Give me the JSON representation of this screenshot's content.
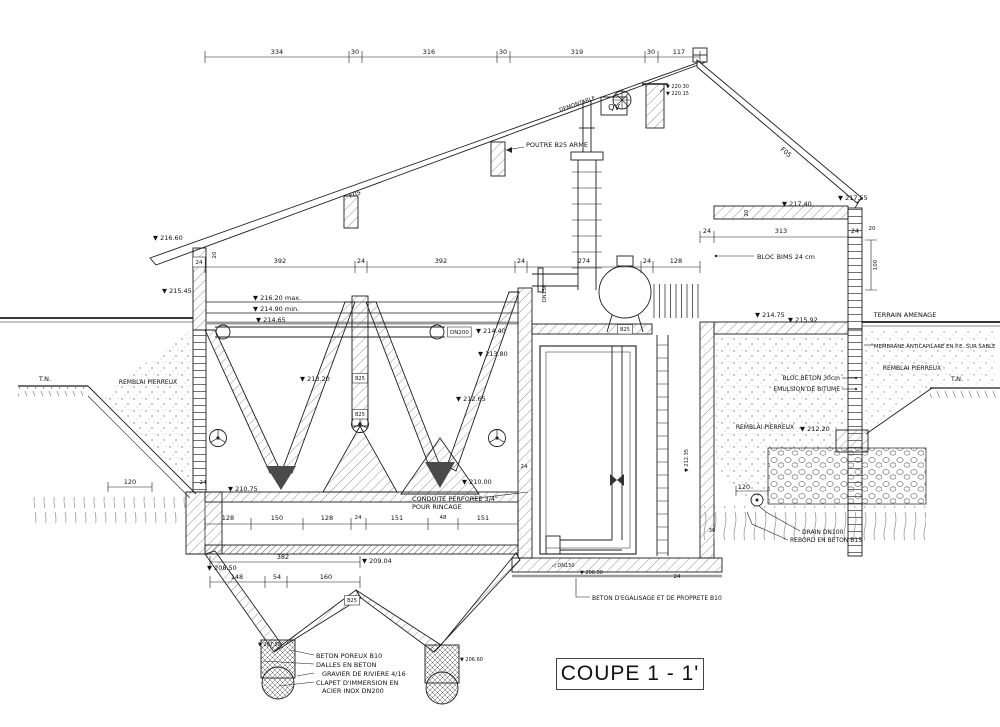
{
  "title": "COUPE 1 - 1'",
  "drawing": {
    "dimension_labels": [
      {
        "name": "dim-334",
        "text": "334",
        "x": 277,
        "y": 54
      },
      {
        "name": "dim-30a",
        "text": "30",
        "x": 355,
        "y": 54
      },
      {
        "name": "dim-316",
        "text": "316",
        "x": 429,
        "y": 54
      },
      {
        "name": "dim-30b",
        "text": "30",
        "x": 503,
        "y": 54
      },
      {
        "name": "dim-319",
        "text": "319",
        "x": 577,
        "y": 54
      },
      {
        "name": "dim-30c",
        "text": "30",
        "x": 651,
        "y": 54
      },
      {
        "name": "dim-117",
        "text": "117",
        "x": 679,
        "y": 54
      },
      {
        "name": "dim-392a",
        "text": "392",
        "x": 280,
        "y": 263
      },
      {
        "name": "dim-24a",
        "text": "24",
        "x": 361,
        "y": 263
      },
      {
        "name": "dim-392b",
        "text": "392",
        "x": 441,
        "y": 263
      },
      {
        "name": "dim-24b",
        "text": "24",
        "x": 521,
        "y": 263
      },
      {
        "name": "dim-274",
        "text": "274",
        "x": 584,
        "y": 263
      },
      {
        "name": "dim-24c",
        "text": "24",
        "x": 647,
        "y": 263
      },
      {
        "name": "dim-128a",
        "text": "128",
        "x": 676,
        "y": 263
      },
      {
        "name": "dim-24-wall",
        "text": "24",
        "x": 199,
        "y": 264,
        "boxed": true,
        "fs": 5.5
      },
      {
        "name": "dim-20-eave",
        "text": "20",
        "x": 216,
        "y": 255,
        "rot": -90,
        "fs": 5.5
      },
      {
        "name": "dim-24d",
        "text": "24",
        "x": 707,
        "y": 233
      },
      {
        "name": "dim-313",
        "text": "313",
        "x": 781,
        "y": 233
      },
      {
        "name": "dim-24e",
        "text": "24",
        "x": 855,
        "y": 233
      },
      {
        "name": "dim-20b",
        "text": "20",
        "x": 872,
        "y": 230,
        "fs": 5.5
      },
      {
        "name": "dim-100",
        "text": "100",
        "x": 877,
        "y": 265,
        "rot": -90,
        "fs": 5.5
      },
      {
        "name": "dim-20c",
        "text": "20",
        "x": 748,
        "y": 213,
        "rot": -90,
        "fs": 5.5
      },
      {
        "name": "dim-120-left",
        "text": "120",
        "x": 130,
        "y": 484
      },
      {
        "name": "dim-24f",
        "text": "24",
        "x": 203,
        "y": 484,
        "fs": 5.5
      },
      {
        "name": "dim-24g",
        "text": "24",
        "x": 524,
        "y": 468,
        "fs": 5.5
      },
      {
        "name": "dim-128b",
        "text": "128",
        "x": 228,
        "y": 520
      },
      {
        "name": "dim-150",
        "text": "150",
        "x": 277,
        "y": 520
      },
      {
        "name": "dim-128c",
        "text": "128",
        "x": 327,
        "y": 520
      },
      {
        "name": "dim-24h",
        "text": "24",
        "x": 358,
        "y": 519,
        "fs": 5.5
      },
      {
        "name": "dim-151a",
        "text": "151",
        "x": 397,
        "y": 520
      },
      {
        "name": "dim-48",
        "text": "48",
        "x": 443,
        "y": 519,
        "fs": 5.5
      },
      {
        "name": "dim-151b",
        "text": "151",
        "x": 483,
        "y": 520
      },
      {
        "name": "dim-382",
        "text": "382",
        "x": 283,
        "y": 559
      },
      {
        "name": "dim-148",
        "text": "148",
        "x": 237,
        "y": 579
      },
      {
        "name": "dim-54",
        "text": "54",
        "x": 277,
        "y": 579
      },
      {
        "name": "dim-160",
        "text": "160",
        "x": 326,
        "y": 579
      },
      {
        "name": "dim-120-right",
        "text": "120",
        "x": 744,
        "y": 489
      },
      {
        "name": "dim-24i",
        "text": "24",
        "x": 677,
        "y": 578,
        "fs": 5.5
      },
      {
        "name": "dim-36",
        "text": "36",
        "x": 712,
        "y": 532,
        "fs": 5.5
      }
    ],
    "elevation_labels": [
      {
        "name": "elev-220-30",
        "text": "▼ 220.30",
        "x": 666,
        "y": 88,
        "fs": 5
      },
      {
        "name": "elev-220-15",
        "text": "▼ 220.15",
        "x": 666,
        "y": 95,
        "fs": 5
      },
      {
        "name": "elev-216-60",
        "text": "▼ 216.60",
        "x": 153,
        "y": 240
      },
      {
        "name": "elev-215-45",
        "text": "▼ 215.45",
        "x": 162,
        "y": 293
      },
      {
        "name": "elev-216-20-max",
        "text": "▼ 216.20 max.",
        "x": 253,
        "y": 300
      },
      {
        "name": "elev-214-90-min",
        "text": "▼ 214.90 min.",
        "x": 253,
        "y": 311
      },
      {
        "name": "elev-214-65",
        "text": "▼ 214.65",
        "x": 256,
        "y": 322
      },
      {
        "name": "elev-214-40",
        "text": "▼ 214.40",
        "x": 476,
        "y": 333
      },
      {
        "name": "elev-213-80",
        "text": "▼ 213.80",
        "x": 478,
        "y": 356
      },
      {
        "name": "elev-213-20",
        "text": "▼ 213.20",
        "x": 300,
        "y": 381
      },
      {
        "name": "elev-212-65",
        "text": "▼ 212.65",
        "x": 456,
        "y": 401
      },
      {
        "name": "elev-217-40",
        "text": "▼ 217.40",
        "x": 782,
        "y": 206
      },
      {
        "name": "elev-217-55",
        "text": "▼ 217.55",
        "x": 838,
        "y": 200
      },
      {
        "name": "elev-214-75",
        "text": "▼ 214.75",
        "x": 755,
        "y": 317
      },
      {
        "name": "elev-215-92",
        "text": "▼ 215.92",
        "x": 788,
        "y": 322
      },
      {
        "name": "elev-212-20",
        "text": "▼ 212.20",
        "x": 800,
        "y": 431
      },
      {
        "name": "elev-210-00",
        "text": "▼ 210.00",
        "x": 462,
        "y": 484
      },
      {
        "name": "elev-210-75",
        "text": "▼ 210.75",
        "x": 228,
        "y": 491
      },
      {
        "name": "elev-208-50",
        "text": "▼ 208.50",
        "x": 207,
        "y": 570
      },
      {
        "name": "elev-209-04",
        "text": "▼ 209.04",
        "x": 362,
        "y": 563
      },
      {
        "name": "elev-207-58",
        "text": "▼ 207.58",
        "x": 258,
        "y": 646,
        "fs": 5
      },
      {
        "name": "elev-206-60",
        "text": "▼ 206.60",
        "x": 460,
        "y": 661,
        "fs": 5
      },
      {
        "name": "elev-208-90",
        "text": "▼ 208.90",
        "x": 580,
        "y": 574,
        "fs": 5
      },
      {
        "name": "elev-212-35",
        "text": "▼ 212.35",
        "x": 688,
        "y": 472,
        "rot": -90,
        "fs": 5
      }
    ],
    "text_labels": [
      {
        "name": "label-poutre",
        "text": "POUTRE B25 ARME",
        "x": 526,
        "y": 147
      },
      {
        "name": "label-demontable",
        "text": "DEMONTABLE",
        "x": 560,
        "y": 112,
        "rot": -19.5,
        "fs": 5.5
      },
      {
        "name": "label-f05-left",
        "text": "F05",
        "x": 350,
        "y": 198,
        "rot": -19.5
      },
      {
        "name": "label-f05-right",
        "text": "F05",
        "x": 780,
        "y": 150,
        "rot": 40
      },
      {
        "name": "label-qv",
        "text": "QV",
        "x": 614,
        "y": 110,
        "anchor": "middle",
        "fs": 8
      },
      {
        "name": "label-bloc-bims",
        "text": "BLOC BIMS 24 cm",
        "x": 757,
        "y": 259
      },
      {
        "name": "label-terrain-amenage",
        "text": "TERRAIN AMENAGE",
        "x": 905,
        "y": 317,
        "anchor": "middle"
      },
      {
        "name": "label-membrane",
        "text": "MEMBRANE ANTICAPILARE EN P.E. SUR SABLE",
        "x": 874,
        "y": 348,
        "fs": 5.3
      },
      {
        "name": "label-remblai-right-upper",
        "text": "REMBLAI PIERREUX",
        "x": 912,
        "y": 370,
        "anchor": "middle",
        "fs": 6
      },
      {
        "name": "label-tn-right",
        "text": "T.N.",
        "x": 957,
        "y": 381,
        "anchor": "middle"
      },
      {
        "name": "label-bloc-beton",
        "text": "BLOC BETON 30cm",
        "x": 840,
        "y": 380,
        "anchor": "end",
        "fs": 6
      },
      {
        "name": "label-emulsion",
        "text": "EMULSION DE BITUME",
        "x": 840,
        "y": 391,
        "anchor": "end",
        "fs": 6
      },
      {
        "name": "label-remblai-right-lower",
        "text": "REMBLAI PIERREUX",
        "x": 765,
        "y": 429,
        "anchor": "middle",
        "fs": 6
      },
      {
        "name": "label-drain",
        "text": "DRAIN DN100",
        "x": 802,
        "y": 534,
        "fs": 6
      },
      {
        "name": "label-rebord",
        "text": "REBORD EN BETON B15",
        "x": 790,
        "y": 542,
        "fs": 6
      },
      {
        "name": "label-tn-left",
        "text": "T.N.",
        "x": 45,
        "y": 381,
        "anchor": "middle"
      },
      {
        "name": "label-remblai-left",
        "text": "REMBLAI PIERREUX",
        "x": 148,
        "y": 384,
        "anchor": "middle",
        "fs": 6
      },
      {
        "name": "label-conduite-1",
        "text": "CONDUITE PERFOREE 3/4\"",
        "x": 412,
        "y": 501
      },
      {
        "name": "label-conduite-2",
        "text": "POUR RINCAGE",
        "x": 412,
        "y": 509
      },
      {
        "name": "label-beton-egalisage",
        "text": "BETON D'EGALISAGE ET DE PROPRETE B10",
        "x": 592,
        "y": 600,
        "fs": 6
      },
      {
        "name": "label-beton-poreux",
        "text": "BETON POREUX B10",
        "x": 316,
        "y": 658
      },
      {
        "name": "label-dalles",
        "text": "DALLES EN BETON",
        "x": 316,
        "y": 667
      },
      {
        "name": "label-gravier",
        "text": "GRAVIER DE RIVIERE 4/16",
        "x": 322,
        "y": 676
      },
      {
        "name": "label-clapet-1",
        "text": "CLAPET D'IMMERSION EN",
        "x": 316,
        "y": 685
      },
      {
        "name": "label-clapet-2",
        "text": "ACIER INOX DN200",
        "x": 322,
        "y": 693
      },
      {
        "name": "label-dn200",
        "text": "DN200",
        "x": 450,
        "y": 334,
        "boxed": true,
        "fs": 5.5
      },
      {
        "name": "label-dn150-vertical",
        "text": "DN150",
        "x": 546,
        "y": 302,
        "rot": -90,
        "fs": 5
      },
      {
        "name": "label-dn150-horizontal",
        "text": "◁ DN150",
        "x": 552,
        "y": 567,
        "fs": 5
      },
      {
        "name": "label-b25-column-1",
        "text": "B25",
        "x": 360,
        "y": 380,
        "anchor": "middle",
        "boxed": true,
        "fs": 5
      },
      {
        "name": "label-b25-column-2",
        "text": "B25",
        "x": 360,
        "y": 416,
        "anchor": "middle",
        "boxed": true,
        "fs": 5
      },
      {
        "name": "label-b25-floor",
        "text": "B25",
        "x": 625,
        "y": 331,
        "anchor": "middle",
        "boxed": true,
        "fs": 5
      },
      {
        "name": "label-b25-bottom",
        "text": "B25",
        "x": 352,
        "y": 602,
        "anchor": "middle",
        "boxed": true,
        "fs": 5
      }
    ]
  }
}
